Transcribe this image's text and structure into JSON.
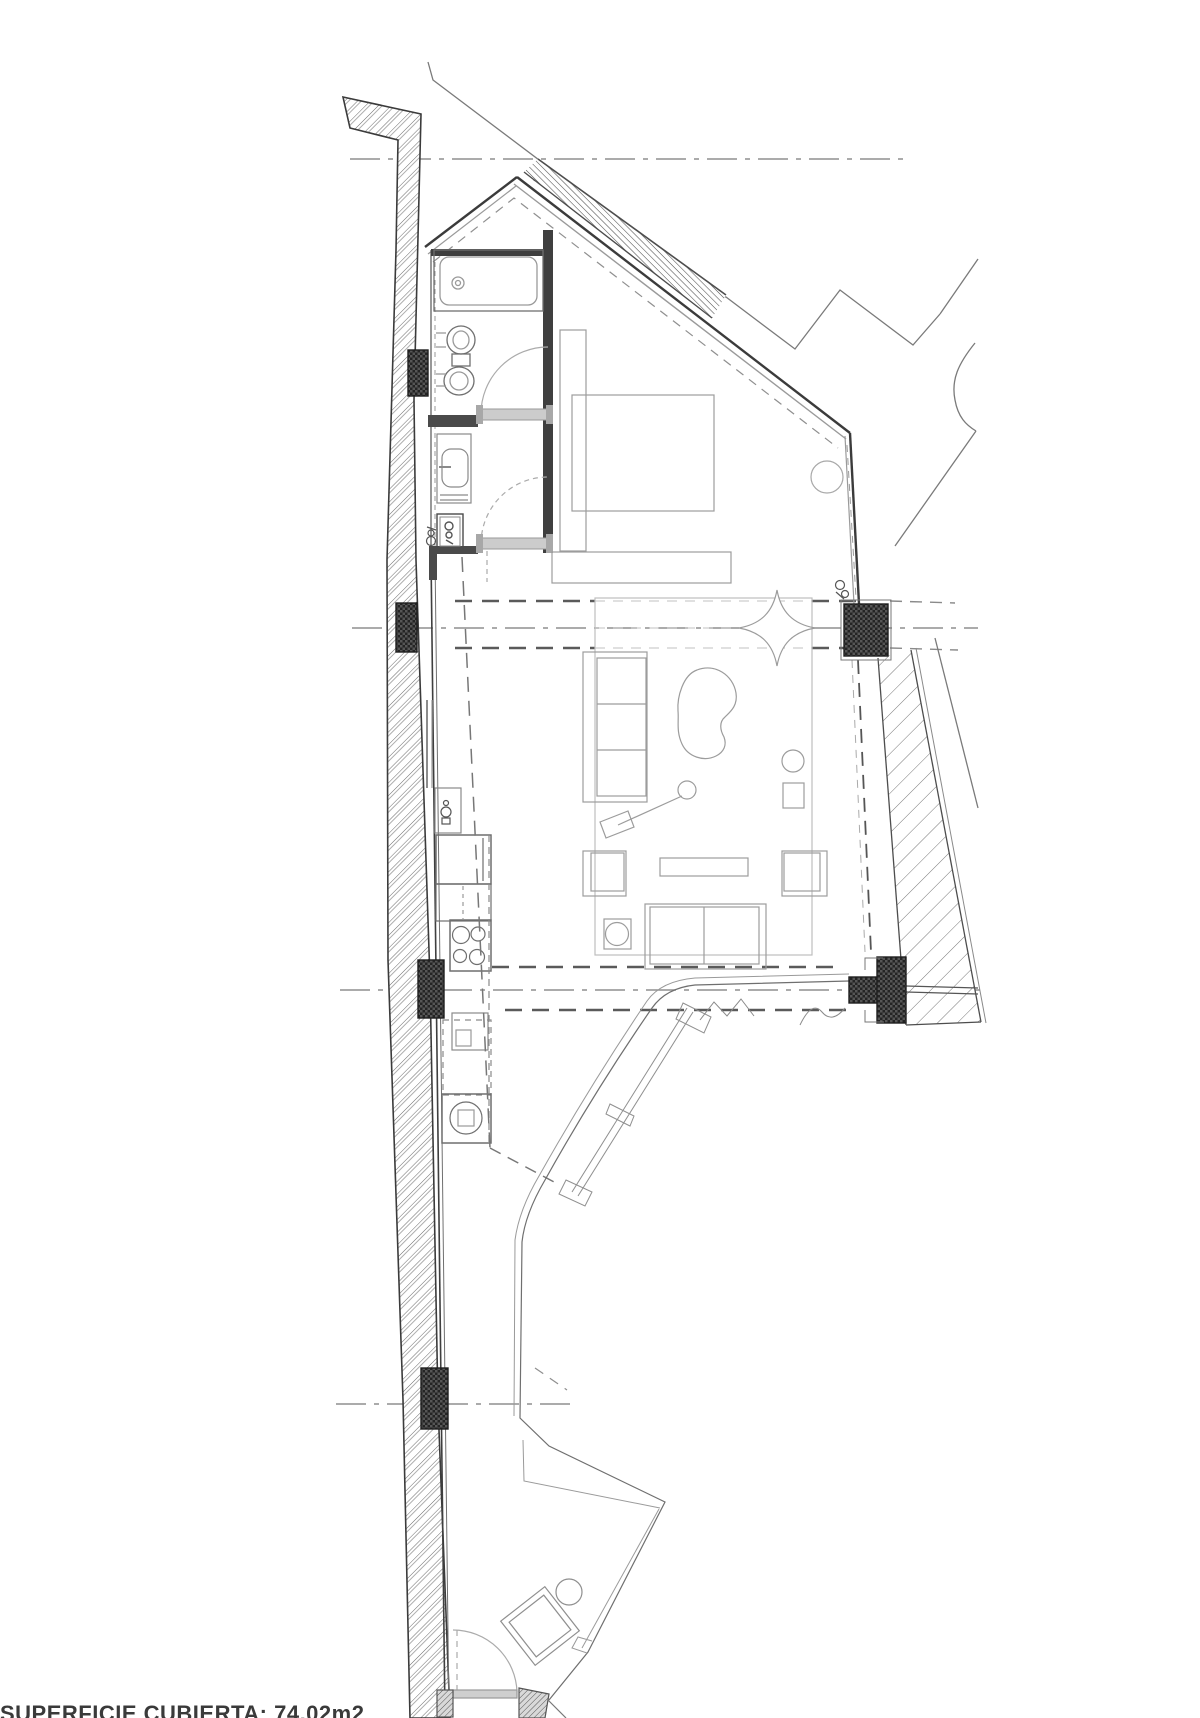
{
  "document": {
    "type": "architectural-floor-plan",
    "caption": {
      "text": "SUPERFICIE CUBIERTA: 74.02m2"
    },
    "area_value": "74.02m2"
  },
  "palette": {
    "paper": "#ffffff",
    "wall_line": "#3b3b3b",
    "furniture_line": "#9c9c9c",
    "centerline": "#8f8f8f",
    "hidden_dash": "#5a5a5a",
    "column_fill": "#2a2a2a"
  },
  "plan": {
    "structural": [
      "party-wall-west",
      "roof-edge-northeast",
      "parapet-east",
      "terrace-parapet",
      "columns"
    ],
    "rooms": [
      "bathroom",
      "toilet-room",
      "bedroom",
      "living-room",
      "kitchen",
      "terrace"
    ],
    "fixtures": [
      "bathtub",
      "toilet",
      "bidet",
      "washbasin",
      "duct-shaft",
      "bed",
      "headboard",
      "foot-bench",
      "sofa",
      "coffee-table",
      "floor-lamp",
      "side-table",
      "plant-star",
      "armchair-left",
      "armchair-right",
      "tv-console",
      "pouf",
      "bench-sofa",
      "rug",
      "fridge",
      "kitchen-sink",
      "hob-4-burners",
      "washing-machine",
      "shower-tray",
      "terrace-lounger"
    ],
    "doors": [
      "bathroom-door",
      "hall-door",
      "terrace-door"
    ],
    "grid_axes_y": [
      159,
      628,
      990,
      1404
    ]
  }
}
